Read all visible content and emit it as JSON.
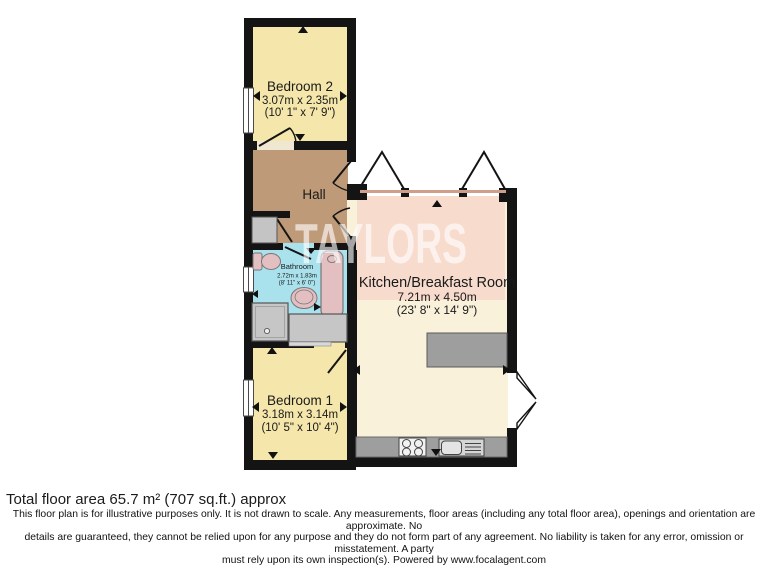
{
  "floorplan": {
    "watermark": "TAYLORS",
    "rooms": {
      "bedroom2": {
        "name": "Bedroom 2",
        "dims_m": "3.07m x 2.35m",
        "dims_ft": "(10' 1\" x 7' 9\")"
      },
      "hall": {
        "name": "Hall"
      },
      "bathroom": {
        "name": "Bathroom",
        "dims_m": "2.72m x 1.83m",
        "dims_ft": "(8' 11\" x 6' 0\")"
      },
      "kitchen": {
        "name": "Kitchen/Breakfast Room",
        "dims_m": "7.21m x 4.50m",
        "dims_ft": "(23' 8\" x 14' 9\")"
      },
      "bedroom1": {
        "name": "Bedroom 1",
        "dims_m": "3.18m x 3.14m",
        "dims_ft": "(10' 5\" x 10' 4\")"
      }
    },
    "colors": {
      "wall": "#141414",
      "bedroom_fill": "#f5e7ab",
      "hall_fill": "#bf9a78",
      "bathroom_fill": "#a9e1ec",
      "kitchen_pink": "#f7dbcd",
      "kitchen_cream": "#f9f1da",
      "counter_gray": "#9e9e9e",
      "fixture_pink": "#e3bfc1"
    }
  },
  "footer": {
    "total_area": "Total floor area 65.7 m² (707 sq.ft.) approx",
    "disclaimer": [
      "This floor plan is for illustrative purposes only. It is not drawn to scale. Any measurements, floor areas (including any total floor area), openings and orientation are approximate. No",
      "details are guaranteed, they cannot be relied upon for any purpose and they do not form part of any agreement. No liability is taken for any error, omission or misstatement. A party",
      "must rely upon its own inspection(s). Powered by www.focalagent.com"
    ]
  }
}
